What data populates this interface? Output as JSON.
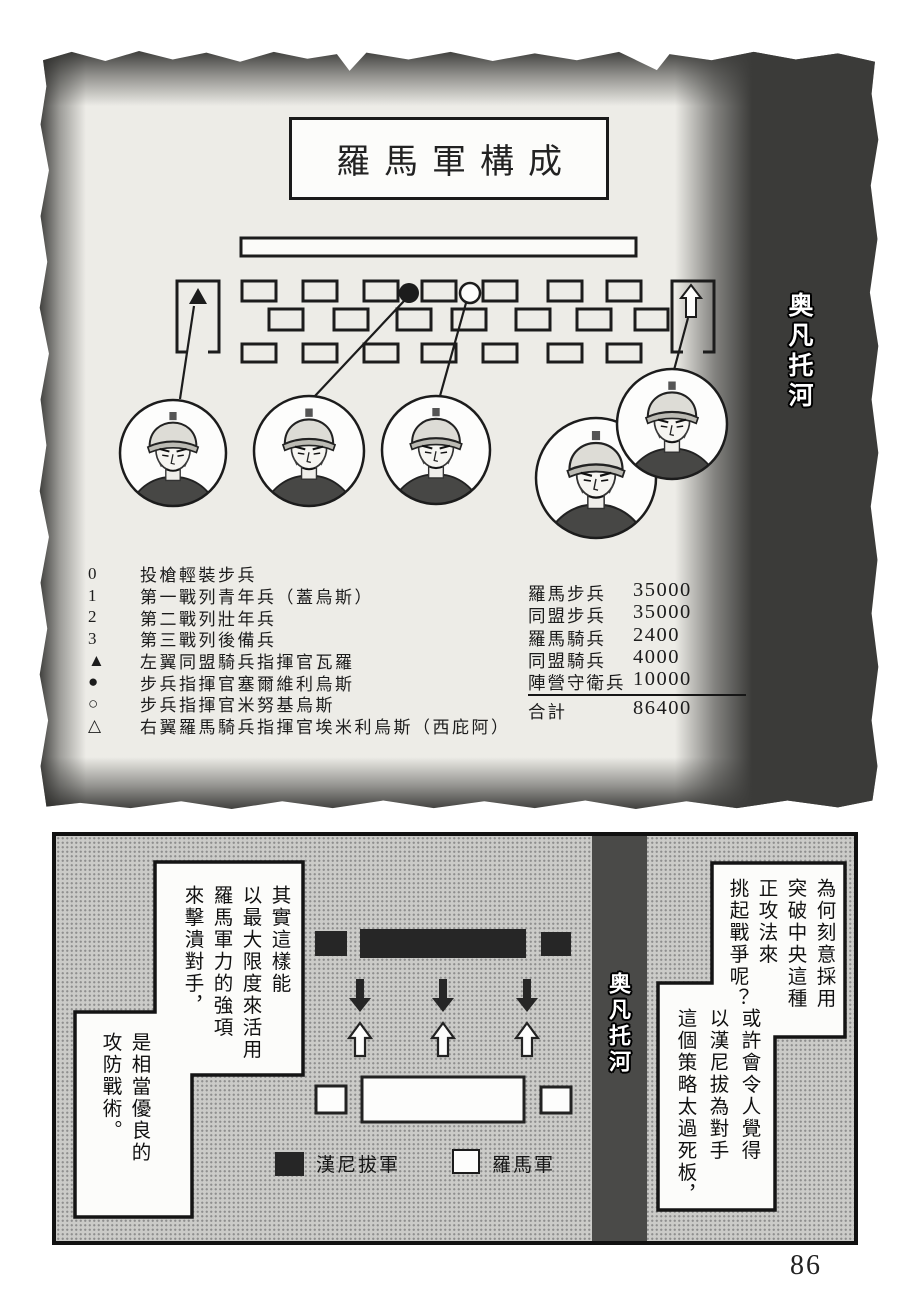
{
  "page": {
    "number": "86"
  },
  "top_panel": {
    "title": "羅馬軍構成",
    "river_label": "奥凡托河",
    "legend": [
      {
        "symbol": "0",
        "label": "投槍輕裝步兵"
      },
      {
        "symbol": "1",
        "label": "第一戰列青年兵（蓋烏斯）"
      },
      {
        "symbol": "2",
        "label": "第二戰列壯年兵"
      },
      {
        "symbol": "3",
        "label": "第三戰列後備兵"
      },
      {
        "symbol": "▲",
        "label": "左翼同盟騎兵指揮官瓦羅"
      },
      {
        "symbol": "●",
        "label": "步兵指揮官塞爾維利烏斯"
      },
      {
        "symbol": "○",
        "label": "步兵指揮官米努基烏斯"
      },
      {
        "symbol": "△",
        "label": "右翼羅馬騎兵指揮官埃米利烏斯（西庇阿）"
      }
    ],
    "troop_table": {
      "rows": [
        {
          "label": "羅馬步兵",
          "value": "35000"
        },
        {
          "label": "同盟步兵",
          "value": "35000"
        },
        {
          "label": "羅馬騎兵",
          "value": "2400"
        },
        {
          "label": "同盟騎兵",
          "value": "4000"
        },
        {
          "label": "陣營守衛兵",
          "value": "10000"
        }
      ],
      "total_label": "合計",
      "total_value": "86400"
    }
  },
  "bottom_panel": {
    "river_label": "奥凡托河",
    "bubbles": {
      "left_top_lines": [
        "其實這樣能",
        "以最大限度來活用",
        "羅馬軍力的強項",
        "來擊潰對手，"
      ],
      "left_bottom_lines": [
        "是相當優良的",
        "攻防戰術。"
      ],
      "right_top_lines": [
        "為何刻意採用",
        "突破中央這種",
        "正攻法來",
        "挑起戰爭呢？"
      ],
      "right_bottom_lines": [
        "或許會令人覺得",
        "以漢尼拔為對手",
        "這個策略太過死板，"
      ]
    },
    "map_legend": {
      "hannibal": "漢尼拔軍",
      "roman": "羅馬軍"
    }
  },
  "colors": {
    "ink": "#1a1a1a",
    "panel_gray": "#cbcbc8",
    "river_dark": "#4a4a48",
    "paper": "#edece7"
  }
}
